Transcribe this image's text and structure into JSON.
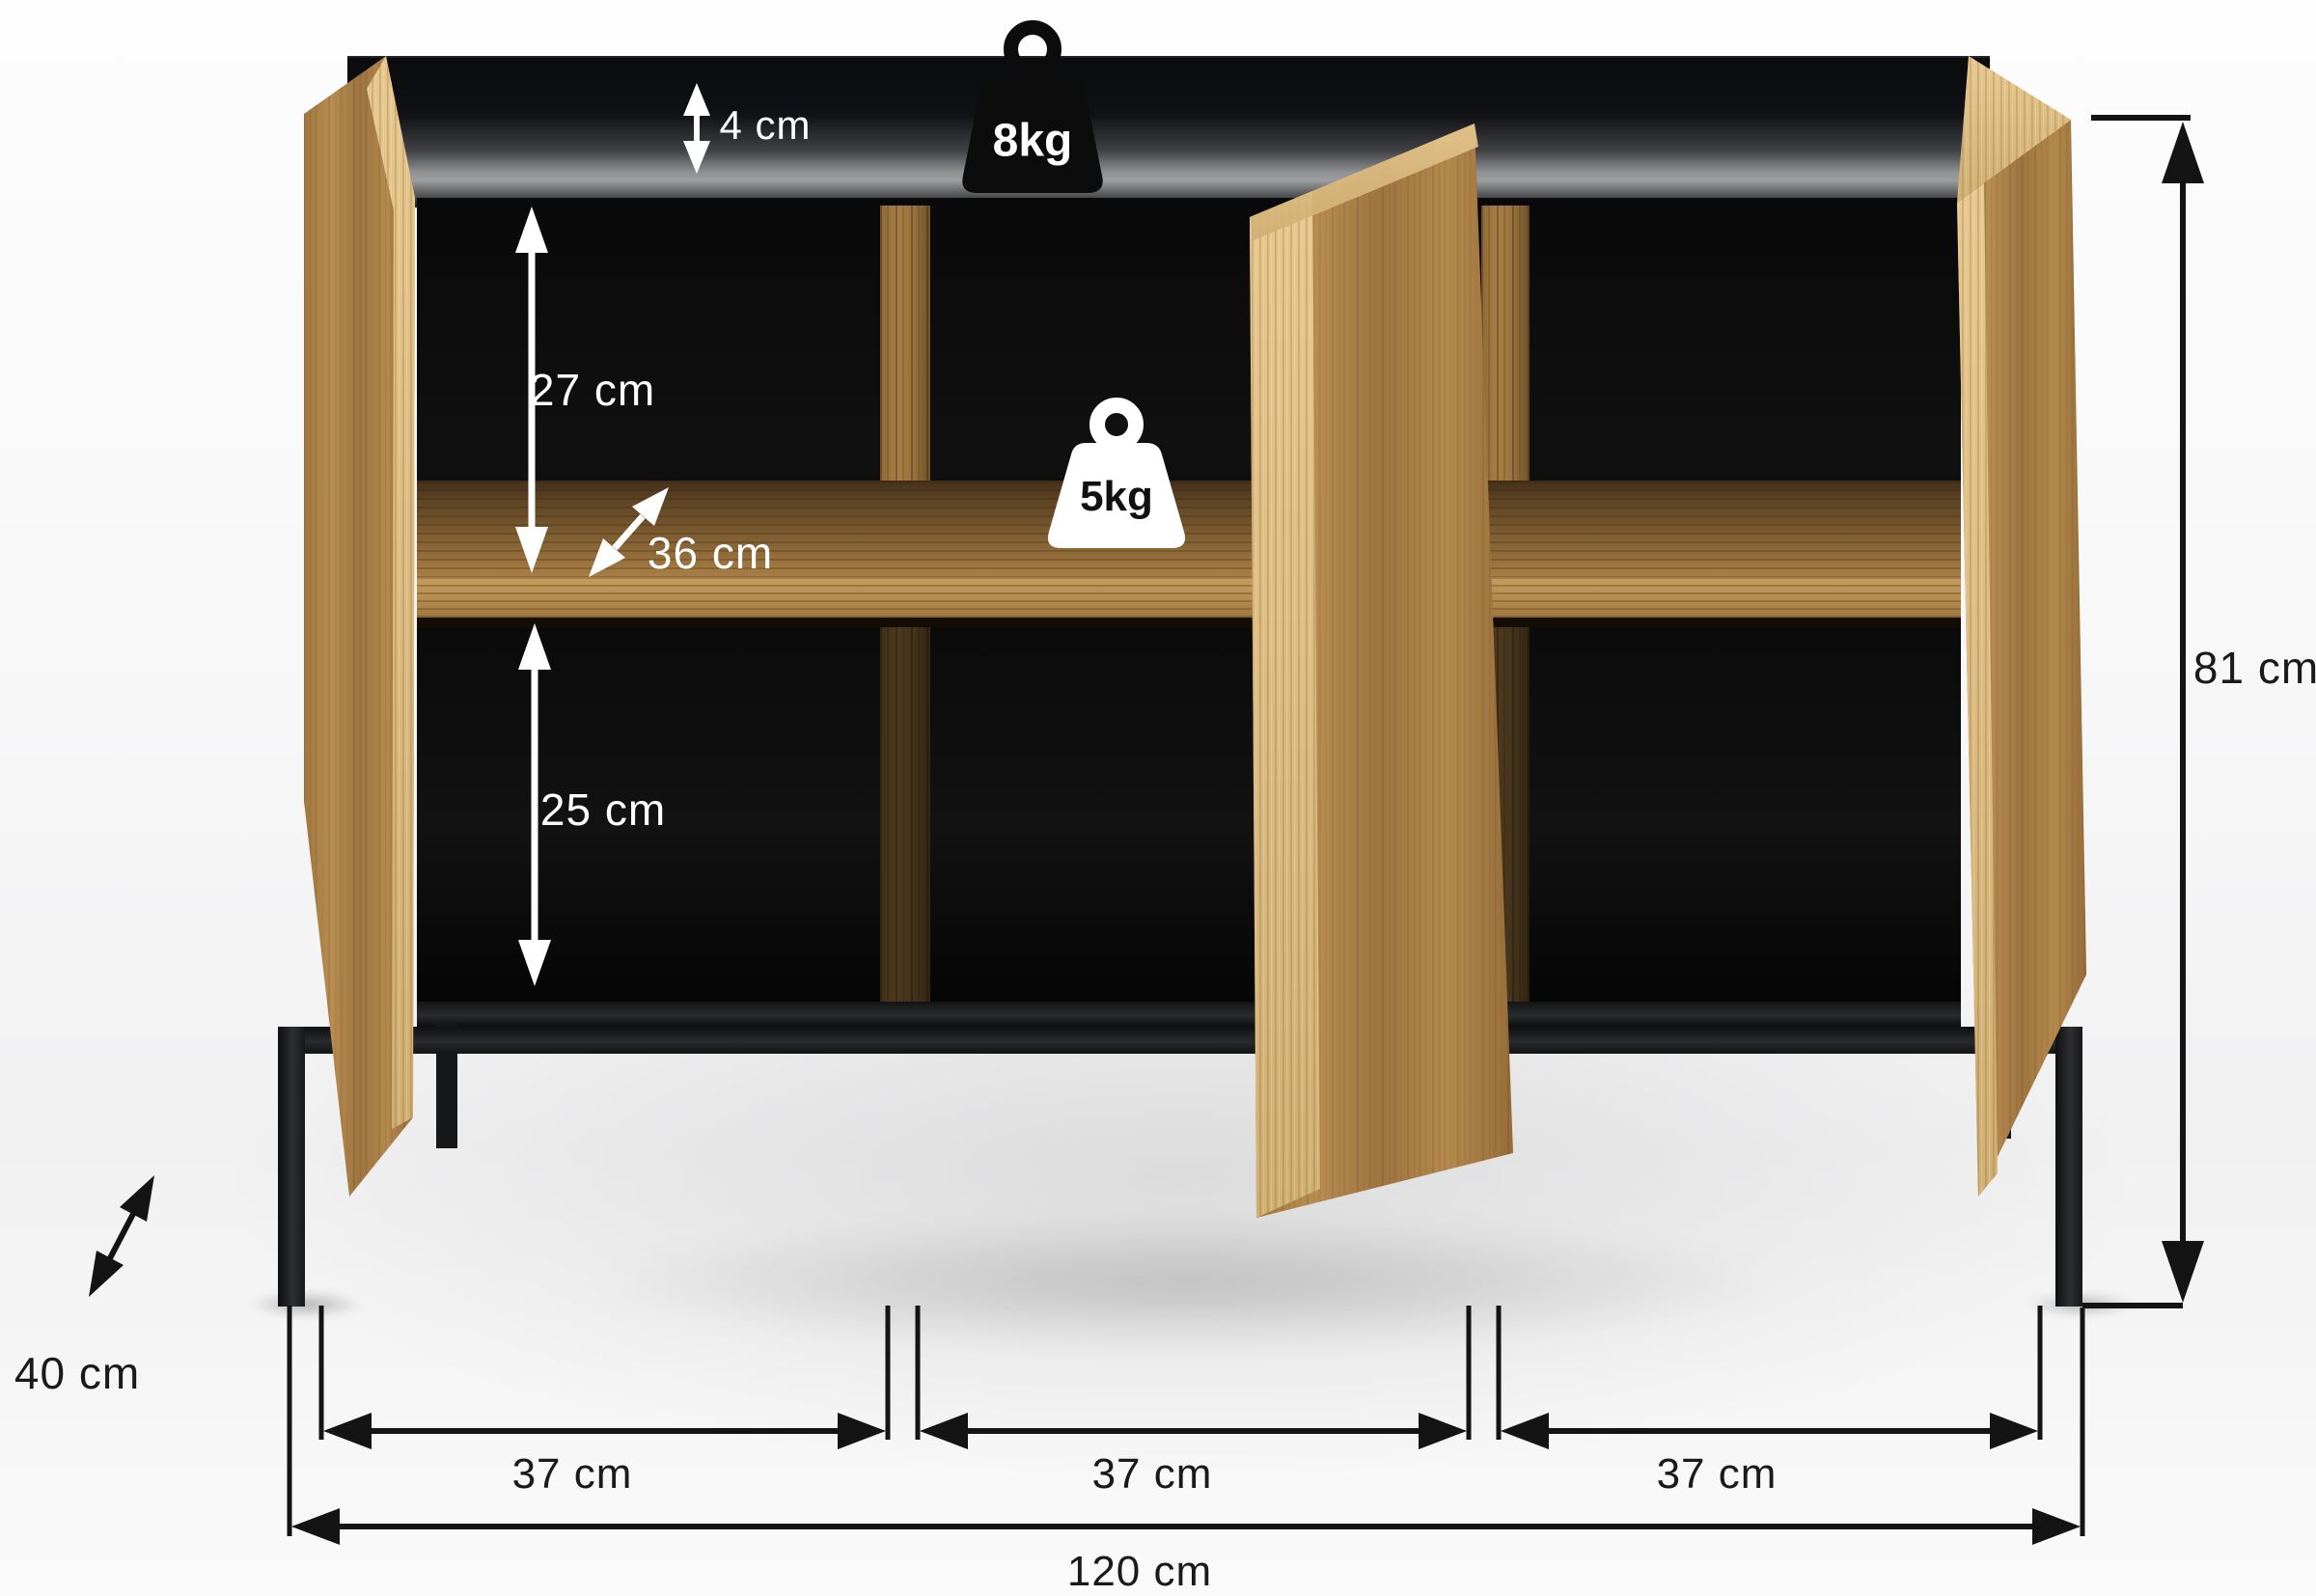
{
  "scene": {
    "type": "furniture-dimension-diagram",
    "background": "#f3f3f4"
  },
  "annotations": {
    "top_panel_thickness": "4 cm",
    "top_max_load": "8kg",
    "upper_compartment_height": "27 cm",
    "compartment_depth": "36 cm",
    "shelf_max_load": "5kg",
    "lower_compartment_height": "25 cm",
    "body_height": "81 cm",
    "total_depth": "40 cm",
    "compartment_widths": [
      "37 cm",
      "37 cm",
      "37 cm"
    ],
    "total_width": "120 cm"
  },
  "icons": [
    {
      "name": "weight-8kg-icon",
      "label": "8kg",
      "fill": "#0c0c0c",
      "text_color": "#ffffff"
    },
    {
      "name": "weight-5kg-icon",
      "label": "5kg",
      "fill": "#ffffff",
      "text_color": "#111111"
    }
  ],
  "colors": {
    "wood": "#b1874c",
    "wood_edge_light": "#ddbe85",
    "panel_dark": "#121316",
    "metal_frame": "#1c1d1f",
    "dimension_dark": "#141414",
    "dimension_light": "#ffffff"
  }
}
